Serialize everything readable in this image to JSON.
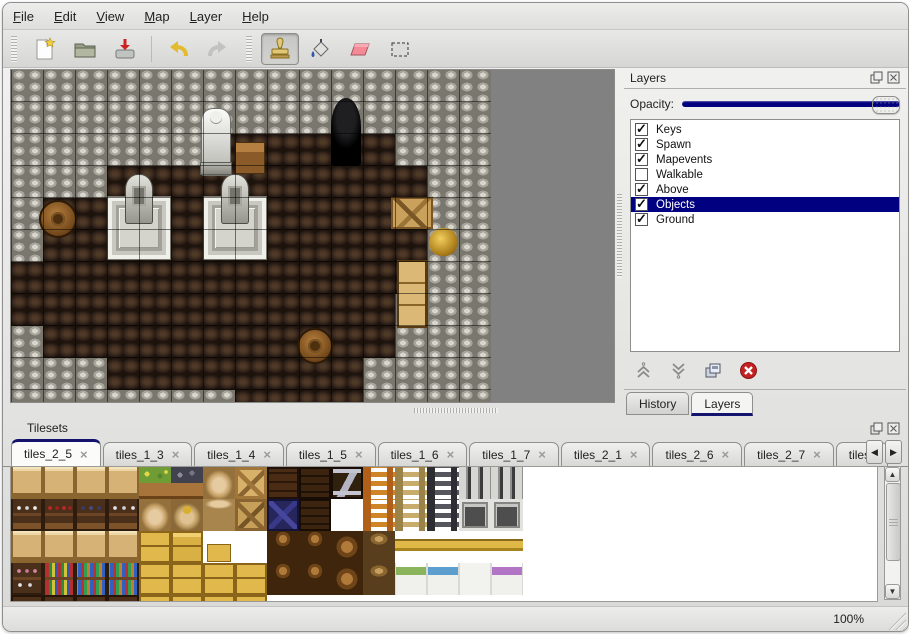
{
  "menubar": {
    "items": [
      {
        "label": "File"
      },
      {
        "label": "Edit"
      },
      {
        "label": "View"
      },
      {
        "label": "Map"
      },
      {
        "label": "Layer"
      },
      {
        "label": "Help"
      }
    ]
  },
  "toolbar": {
    "tools": [
      {
        "name": "new"
      },
      {
        "name": "open"
      },
      {
        "name": "save"
      },
      {
        "name": "undo"
      },
      {
        "name": "redo"
      },
      {
        "name": "stamp",
        "active": true
      },
      {
        "name": "fill"
      },
      {
        "name": "eraser"
      },
      {
        "name": "select"
      }
    ],
    "active_tool": "stamp"
  },
  "layers_panel": {
    "title": "Layers",
    "opacity_label": "Opacity:",
    "opacity_value": 1.0,
    "items": [
      {
        "label": "Keys",
        "checked": true,
        "selected": false
      },
      {
        "label": "Spawn",
        "checked": true,
        "selected": false
      },
      {
        "label": "Mapevents",
        "checked": true,
        "selected": false
      },
      {
        "label": "Walkable",
        "checked": false,
        "selected": false
      },
      {
        "label": "Above",
        "checked": true,
        "selected": false
      },
      {
        "label": "Objects",
        "checked": true,
        "selected": true
      },
      {
        "label": "Ground",
        "checked": true,
        "selected": false
      }
    ],
    "buttons": [
      "raise-layer",
      "lower-layer",
      "duplicate-layer",
      "delete-layer"
    ],
    "tabs": [
      {
        "label": "History",
        "active": false
      },
      {
        "label": "Layers",
        "active": true
      }
    ]
  },
  "tilesets_panel": {
    "title": "Tilesets",
    "tabs": [
      {
        "label": "tiles_2_5",
        "active": true
      },
      {
        "label": "tiles_1_3",
        "active": false
      },
      {
        "label": "tiles_1_4",
        "active": false
      },
      {
        "label": "tiles_1_5",
        "active": false
      },
      {
        "label": "tiles_1_6",
        "active": false
      },
      {
        "label": "tiles_1_7",
        "active": false
      },
      {
        "label": "tiles_2_1",
        "active": false
      },
      {
        "label": "tiles_2_6",
        "active": false
      },
      {
        "label": "tiles_2_7",
        "active": false
      },
      {
        "label": "tiles_",
        "active": false,
        "partial": true
      }
    ],
    "close_glyph": "×",
    "grid": [
      [
        "shelfTop",
        "shelfTop",
        "shelfTop",
        "shelfTop",
        "plantBox",
        "oreBox",
        "sackTall",
        "crateX",
        "crateDark",
        "darkShelf",
        "metalZ",
        "ladderO",
        "ladderT",
        "ladderD",
        "archTop",
        "archTop",
        "empty"
      ],
      [
        "shelfDish",
        "shelfRed",
        "shelfBlue",
        "shelfJars",
        "sack",
        "sackOpen",
        "sackStack",
        "crateX2",
        "blueCrate",
        "darkShelf",
        "empty",
        "ladderO",
        "ladderT",
        "ladderD",
        "archDoor",
        "archDoor",
        "empty"
      ],
      [
        "shelfTop",
        "shelfTop",
        "shelfTop",
        "shelfTop",
        "crateGold",
        "crateGoldTall",
        "crateGoldS",
        "empty",
        "barrelPile",
        "barrelPile",
        "barrel",
        "potStack",
        "bedHead",
        "bedHead",
        "bedHead",
        "bedHead",
        "empty"
      ],
      [
        "shelfPink",
        "shelfBooks",
        "shelfBottles",
        "shelfBottles",
        "crateGold",
        "crateGold",
        "crateGold",
        "crateGold",
        "barrelPile",
        "barrelPile",
        "barrel",
        "potStack",
        "bedGreen",
        "bedBlue",
        "bedWhite",
        "bedPurple",
        "empty"
      ],
      [
        "shelfDark",
        "shelfDark",
        "shelfDark",
        "shelfDark",
        "crateGold",
        "crateGold",
        "crateGold",
        "crateGold",
        "empty",
        "empty",
        "empty",
        "empty",
        "empty",
        "empty",
        "empty",
        "empty",
        "empty"
      ]
    ]
  },
  "map": {
    "tile_size": 32,
    "grid": [
      "WWWWWWWWWWWWWWW",
      "WWWWWWWWWWWWWWW",
      "WWWWWWFFFFFFWWW",
      "WWWFFFFFFFFFFWW",
      "WFFFFFFFFFFFFWW",
      "WFFFFFFFFFFFFWW",
      "FFFFFFFFFFFFFWW",
      "FFFFFFFFFFFFWWW",
      "WFFFFFFFFFFFWWW",
      "WWWFFFFFFFFWWWW",
      "WWWWWWWFFFFWWWW"
    ],
    "objects": [
      {
        "type": "platform",
        "x": 96,
        "y": 126,
        "w": 64,
        "h": 64
      },
      {
        "type": "platform",
        "x": 192,
        "y": 126,
        "w": 64,
        "h": 64
      },
      {
        "type": "grave",
        "x": 114,
        "y": 104,
        "w": 28,
        "h": 50
      },
      {
        "type": "grave",
        "x": 210,
        "y": 104,
        "w": 28,
        "h": 50
      },
      {
        "type": "statue",
        "x": 190,
        "y": 38,
        "w": 30,
        "h": 68
      },
      {
        "type": "table",
        "x": 224,
        "y": 72,
        "w": 30,
        "h": 32
      },
      {
        "type": "door",
        "x": 320,
        "y": 28,
        "w": 30,
        "h": 68
      },
      {
        "type": "crate",
        "x": 380,
        "y": 127,
        "w": 42,
        "h": 32
      },
      {
        "type": "barrel",
        "x": 28,
        "y": 130,
        "w": 38,
        "h": 38
      },
      {
        "type": "amphora",
        "x": 418,
        "y": 158,
        "w": 28,
        "h": 28
      },
      {
        "type": "cabinet",
        "x": 386,
        "y": 190,
        "w": 30,
        "h": 68
      },
      {
        "type": "barrel",
        "x": 286,
        "y": 258,
        "w": 36,
        "h": 36
      }
    ]
  },
  "statusbar": {
    "zoom": "100%"
  },
  "colors": {
    "accent": "#000080",
    "selection_bg": "#000080",
    "tab_active_stripe": "#14146e",
    "map_bg": "#818181"
  }
}
